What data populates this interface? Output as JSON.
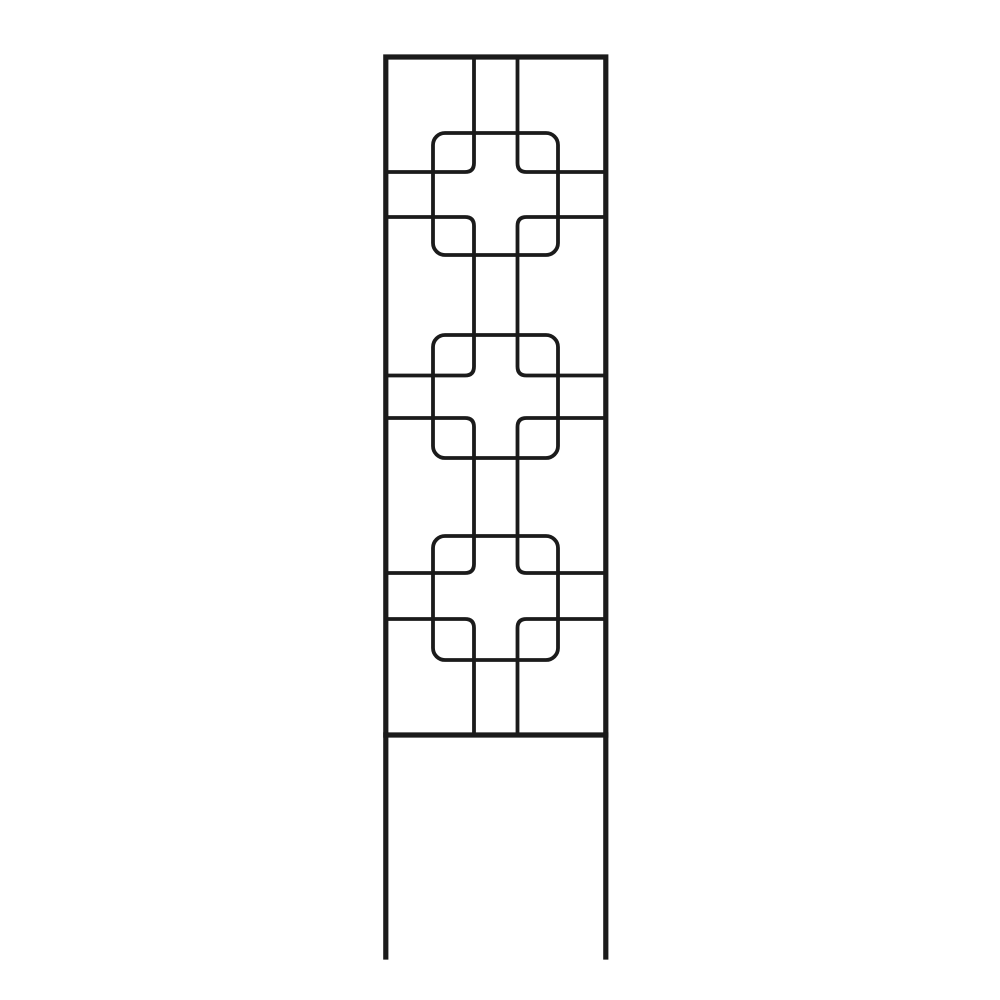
{
  "canvas": {
    "width": 1000,
    "height": 1000,
    "background_color": "#ffffff"
  },
  "scene": {
    "subject": "black metal garden trellis panel with repeating squares-and-cross wire motif",
    "setting": "studio product photo, plain white background, no text",
    "object_color": "#1b1b1b",
    "motif_count": 3
  },
  "trellis": {
    "stroke_color": "#1b1b1b",
    "frame": {
      "stroke_width": 5.2,
      "elements": [
        {
          "name": "frame-outline",
          "d": "M 385.8 57 H 605.8 V 735 H 385.8 Z"
        },
        {
          "name": "frame-leg-left",
          "d": "M 385.8 735 V 957"
        },
        {
          "name": "frame-leg-right",
          "d": "M 605.8 735 V 957"
        }
      ]
    },
    "wires": {
      "stroke_width": 3.8,
      "elements": [
        {
          "name": "wire-left-top-drop",
          "d": "M 474 58 L 474 163 Q 474 172 465 172 L 388 172"
        },
        {
          "name": "wire-left-link-1",
          "d": "M 388 217 L 465 217 Q 474 217 474 226 L 474 366.5 Q 474 375.5 465 375.5 L 388 375.5"
        },
        {
          "name": "wire-left-link-2",
          "d": "M 388 418 L 465 418 Q 474 418 474 427 L 474 564 Q 474 573 465 573 L 388 573"
        },
        {
          "name": "wire-left-bottom-drop",
          "d": "M 388 619 L 465 619 Q 474 619 474 628 L 474 733"
        },
        {
          "name": "wire-right-top-drop",
          "d": "M 517.5 58 L 517.5 163 Q 517.5 172 526.5 172 L 603.5 172"
        },
        {
          "name": "wire-right-link-1",
          "d": "M 603.5 217 L 526.5 217 Q 517.5 217 517.5 226 L 517.5 366.5 Q 517.5 375.5 526.5 375.5 L 603.5 375.5"
        },
        {
          "name": "wire-right-link-2",
          "d": "M 603.5 418 L 526.5 418 Q 517.5 418 517.5 427 L 517.5 564 Q 517.5 573 526.5 573 L 603.5 573"
        },
        {
          "name": "wire-right-bottom-drop",
          "d": "M 603.5 619 L 526.5 619 Q 517.5 619 517.5 628 L 517.5 733"
        }
      ]
    },
    "squares": {
      "stroke_width": 3.8,
      "corner_radius": 12,
      "elements": [
        {
          "name": "motif-1-square",
          "x": 433,
          "y": 133,
          "width": 125,
          "height": 122
        },
        {
          "name": "motif-2-square",
          "x": 433,
          "y": 335,
          "width": 125,
          "height": 123
        },
        {
          "name": "motif-3-square",
          "x": 433,
          "y": 536,
          "width": 125,
          "height": 124
        }
      ]
    }
  }
}
